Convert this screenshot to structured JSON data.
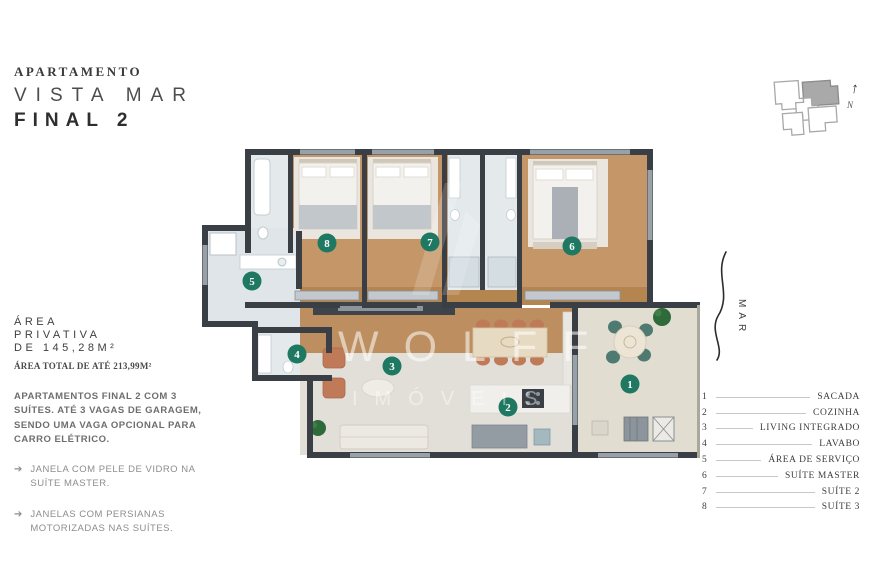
{
  "title": {
    "kicker": "APARTAMENTO",
    "line1": "VISTA MAR",
    "line2": "FINAL 2"
  },
  "area": {
    "line1": "ÁREA",
    "line2": "PRIVATIVA",
    "line3": "DE 145,28M²",
    "total": "ÁREA TOTAL DE ATÉ 213,99M²"
  },
  "description": {
    "paragraph": "APARTAMENTOS FINAL 2 COM 3 SUÍTES. ATÉ 3 VAGAS DE GARAGEM, SENDO UMA VAGA OPCIONAL PARA CARRO ELÉTRICO.",
    "bullets": [
      {
        "icon": "➔",
        "text": "JANELA COM PELE DE VIDRO NA SUÍTE MASTER."
      },
      {
        "icon": "➔",
        "text": "JANELAS COM PERSIANAS MOTORIZADAS NAS SUÍTES."
      }
    ]
  },
  "compass": {
    "north_label": "N"
  },
  "sea_label": "MAR",
  "watermark": {
    "line1": "WOLFF",
    "line2": "IMÓVEIS"
  },
  "legend": {
    "items": [
      {
        "num": "1",
        "label": "SACADA"
      },
      {
        "num": "2",
        "label": "COZINHA"
      },
      {
        "num": "3",
        "label": "LIVING INTEGRADO"
      },
      {
        "num": "4",
        "label": "LAVABO"
      },
      {
        "num": "5",
        "label": "ÁREA DE SERVIÇO"
      },
      {
        "num": "6",
        "label": "SUÍTE MASTER"
      },
      {
        "num": "7",
        "label": "SUÍTE 2"
      },
      {
        "num": "8",
        "label": "SUÍTE 3"
      }
    ]
  },
  "colors": {
    "accent_marker": "#1e7862",
    "wall": "#3a3f46",
    "wood_floor": "#bd8e60",
    "tile_floor": "#e2dfd9",
    "bath_floor": "#e4eaec",
    "balcony_floor": "#e1ddd0",
    "terracotta": "#c07a57",
    "teal_chair": "#4e7a71"
  }
}
